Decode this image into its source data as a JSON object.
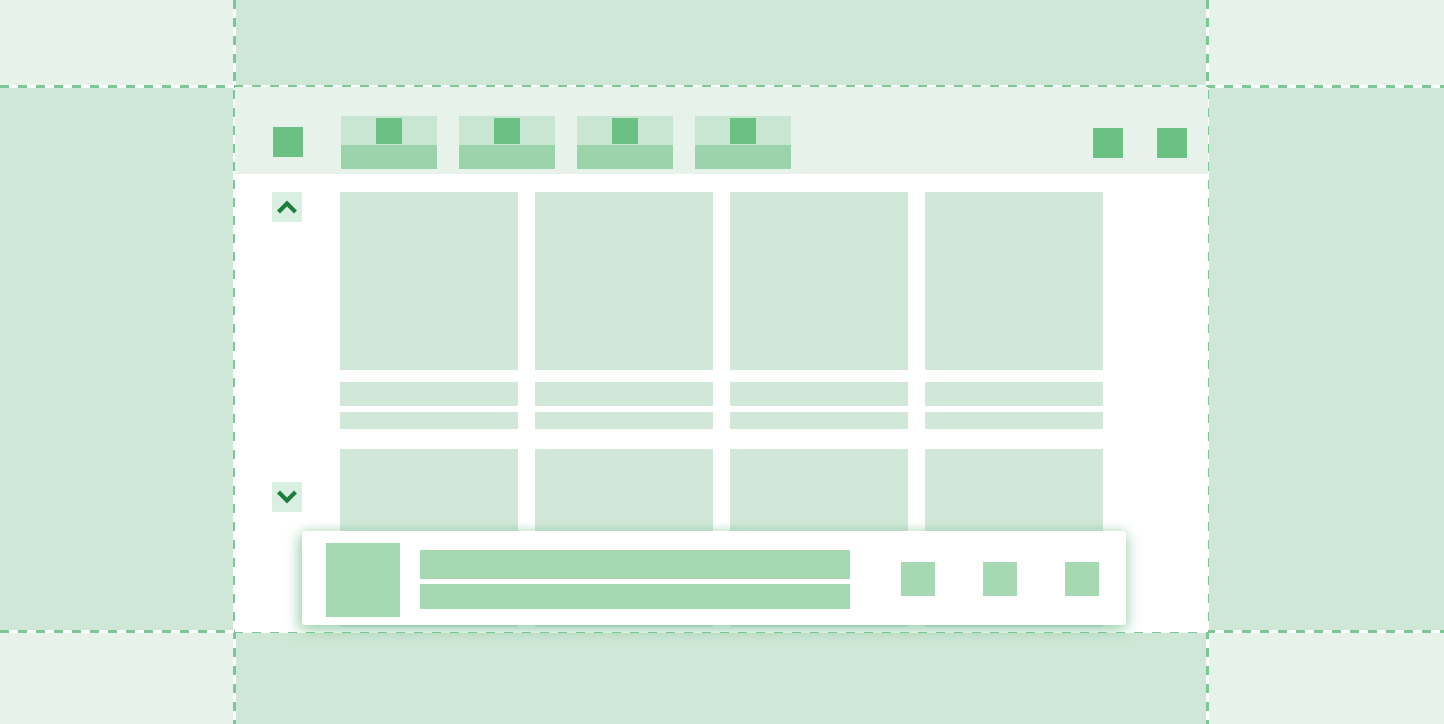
{
  "palette": {
    "bg_light": "#e7f3ea",
    "bg_medium": "#cfe7d6",
    "window_bg": "#ffffff",
    "card_fill": "#d1e8d9",
    "tab_fill": "#c9e6d2",
    "tab_label_bar": "#9bd4ab",
    "accent_square": "#6bc183",
    "scroll_btn_bg": "#d9efdf",
    "scroll_chevron": "#1b7d3f",
    "toast_bg": "#ffffff",
    "toast_item": "#a6d8b2",
    "dash_line": "#7cc794"
  },
  "background": {
    "pattern": "3x3-checkerboard",
    "guide_lines": {
      "vertical_x": [
        235,
        1208
      ],
      "horizontal_y": [
        87,
        632
      ],
      "style": "dashed"
    }
  },
  "window": {
    "toolbar": {
      "app_button": {
        "icon": "app-square-icon"
      },
      "tabs": [
        {
          "icon": "tab-thumbnail-square-icon"
        },
        {
          "icon": "tab-thumbnail-square-icon"
        },
        {
          "icon": "tab-thumbnail-square-icon"
        },
        {
          "icon": "tab-thumbnail-square-icon"
        }
      ],
      "actions": [
        {
          "icon": "toolbar-action-square-icon"
        },
        {
          "icon": "toolbar-action-square-icon"
        }
      ]
    },
    "scroll_up_button": {
      "icon": "chevron-up-icon"
    },
    "scroll_down_button": {
      "icon": "chevron-down-icon"
    },
    "cards": {
      "row1": [
        {
          "media": "image-placeholder",
          "text_lines": 2
        },
        {
          "media": "image-placeholder",
          "text_lines": 2
        },
        {
          "media": "image-placeholder",
          "text_lines": 2
        },
        {
          "media": "image-placeholder",
          "text_lines": 2
        }
      ],
      "row2": [
        {
          "media": "image-placeholder"
        },
        {
          "media": "image-placeholder"
        },
        {
          "media": "image-placeholder"
        },
        {
          "media": "image-placeholder"
        }
      ]
    }
  },
  "toast": {
    "avatar": {
      "icon": "avatar-square-placeholder"
    },
    "text_lines": [
      {
        "kind": "title-bar-placeholder"
      },
      {
        "kind": "subtitle-bar-placeholder"
      }
    ],
    "buttons": [
      {
        "icon": "toast-action-square-icon"
      },
      {
        "icon": "toast-action-square-icon"
      },
      {
        "icon": "toast-action-square-icon"
      }
    ]
  }
}
